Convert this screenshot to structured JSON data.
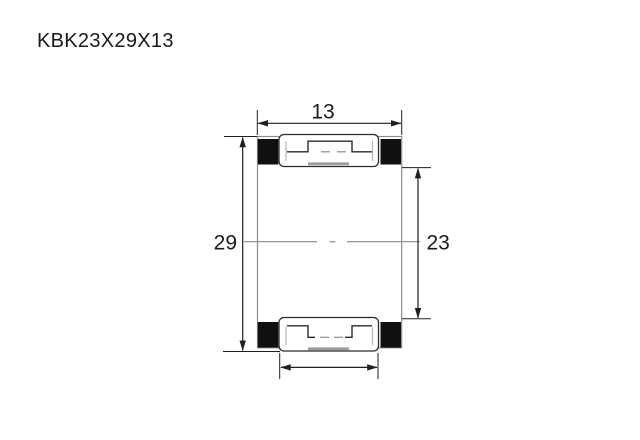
{
  "title": "KBK23X29X13",
  "drawing": {
    "type": "needle-roller-cage-bearing-cross-section",
    "dimensions": {
      "width_label": "13",
      "outer_diameter_label": "29",
      "bore_diameter_label": "23"
    },
    "colors": {
      "background": "#ffffff",
      "text": "#1a1a1a",
      "line_dark": "#1f1f1f",
      "outline_gray": "#8c8c8c",
      "roller_outline": "#2b2b2b",
      "roller_fill": "#ffffff",
      "section_fill": "#101010",
      "detail_light": "#b5b5b5",
      "detail_mid": "#9e9e9e"
    }
  }
}
